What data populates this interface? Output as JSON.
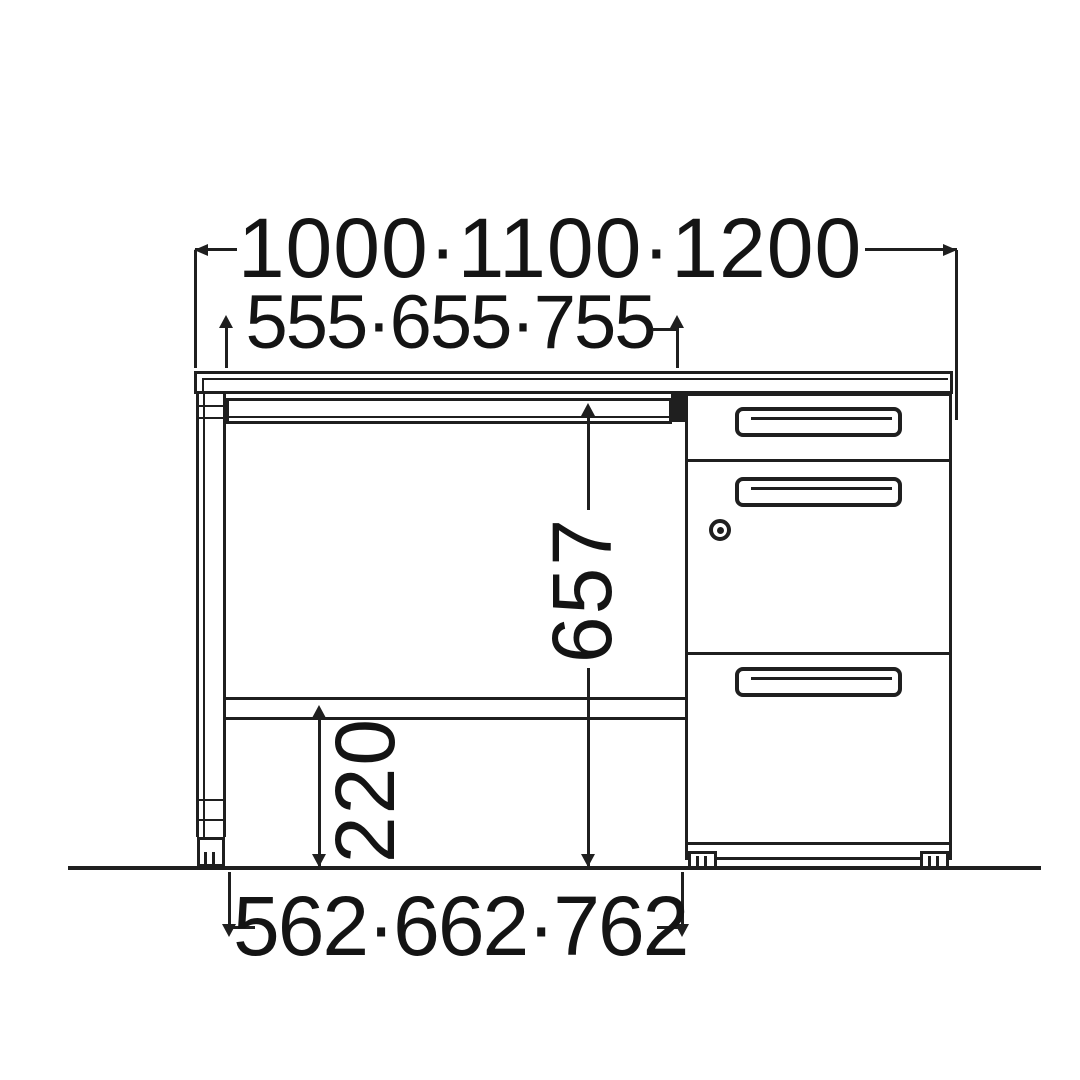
{
  "diagram": {
    "type": "furniture-dimension-drawing",
    "subject": "desk-with-drawer-pedestal-front-elevation",
    "dimensions": {
      "overall_width": "1000·1100·1200",
      "top_inner_width": "555·655·755",
      "knee_clearance_height": "657",
      "under_shelf_height": "220",
      "bottom_inner_width": "562·662·762"
    },
    "colors": {
      "line": "#1f1f1f",
      "text": "#141414",
      "background": "#ffffff"
    }
  }
}
